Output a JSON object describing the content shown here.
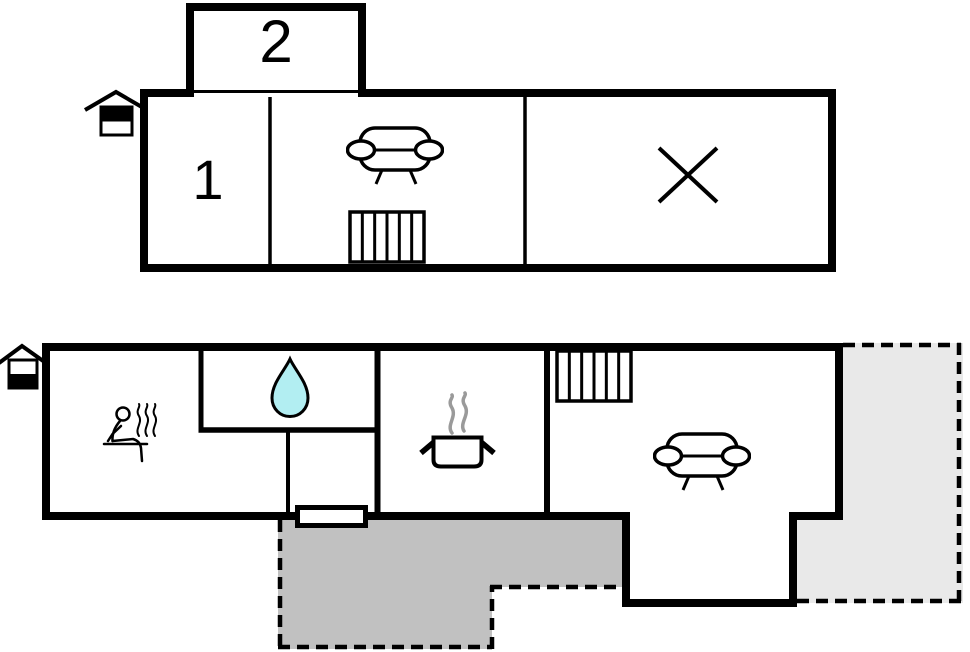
{
  "canvas": {
    "width": 970,
    "height": 652,
    "background": "#ffffff"
  },
  "colors": {
    "wall": "#000000",
    "floor_fill": "#ffffff",
    "terrace_dark_fill": "#c1c1c1",
    "terrace_light_fill": "#e9e9e9",
    "water_drop_fill": "#b2eef2",
    "steam": "#9a9a9a",
    "dash": "#000000"
  },
  "upper_floor": {
    "plan_name": "upper-floor-plan",
    "level_icon": "house-upper-level-icon",
    "room_labels": {
      "room2": "2",
      "room1": "1"
    },
    "features": [
      "sofa-icon",
      "stairs-icon",
      "cross-icon"
    ]
  },
  "ground_floor": {
    "plan_name": "ground-floor-plan",
    "level_icon": "house-ground-level-icon",
    "room_labels": {},
    "features": [
      "sauna-icon",
      "water-drop-icon",
      "cooking-pot-icon",
      "stairs-icon",
      "sofa-icon",
      "entrance-door",
      "terrace-dark",
      "terrace-light"
    ]
  }
}
